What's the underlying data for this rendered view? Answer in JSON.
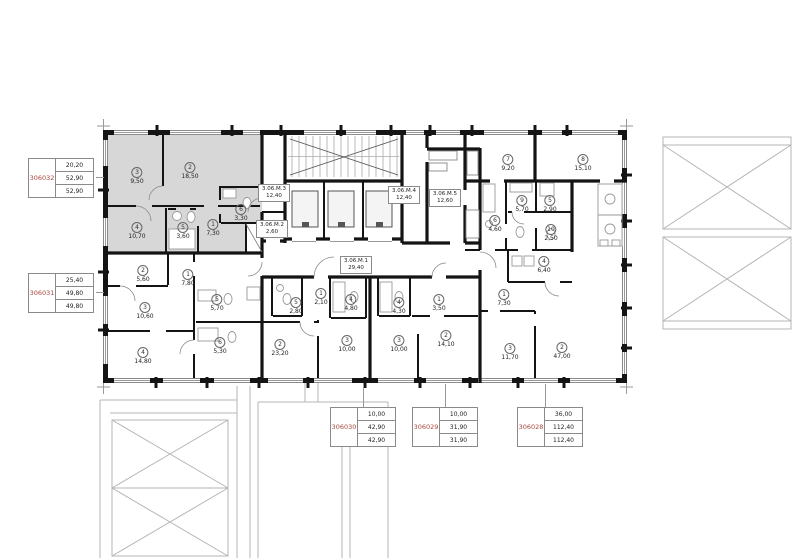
{
  "colors": {
    "accent-red": "#a8493e",
    "highlight": "#d7d7d7",
    "wall": "#141414",
    "line": "#999999",
    "neighbor": "#b5b5b5"
  },
  "units": [
    {
      "id": "306032",
      "highlighted": true,
      "tag_values": [
        "20,20",
        "52,90",
        "52,90"
      ],
      "rooms": [
        {
          "n": "3",
          "area": "9,50"
        },
        {
          "n": "2",
          "area": "18,50"
        },
        {
          "n": "4",
          "area": "10,70"
        },
        {
          "n": "5",
          "area": "3,60"
        },
        {
          "n": "1",
          "area": "7,30"
        },
        {
          "n": "6",
          "area": "3,30"
        }
      ]
    },
    {
      "id": "306031",
      "highlighted": false,
      "tag_values": [
        "25,40",
        "49,80",
        "49,80"
      ],
      "rooms": [
        {
          "n": "2",
          "area": "5,60"
        },
        {
          "n": "1",
          "area": "7,80"
        },
        {
          "n": "3",
          "area": "10,60"
        },
        {
          "n": "5",
          "area": "5,70"
        },
        {
          "n": "6",
          "area": "5,30"
        },
        {
          "n": "4",
          "area": "14,80"
        }
      ]
    },
    {
      "id": "306030",
      "highlighted": false,
      "tag_values": [
        "10,00",
        "42,90",
        "42,90"
      ],
      "rooms": [
        {
          "n": "5",
          "area": "2,80"
        },
        {
          "n": "1",
          "area": "2,10"
        },
        {
          "n": "4",
          "area": "4,80"
        },
        {
          "n": "3",
          "area": "10,00"
        },
        {
          "n": "2",
          "area": "23,20"
        }
      ]
    },
    {
      "id": "306029",
      "highlighted": false,
      "tag_values": [
        "10,00",
        "31,90",
        "31,90"
      ],
      "rooms": [
        {
          "n": "4",
          "area": "4,30"
        },
        {
          "n": "3",
          "area": "10,00"
        },
        {
          "n": "1",
          "area": "3,50"
        },
        {
          "n": "2",
          "area": "14,10"
        }
      ]
    },
    {
      "id": "306028",
      "highlighted": false,
      "tag_values": [
        "36,00",
        "112,40",
        "112,40"
      ],
      "rooms": [
        {
          "n": "7",
          "area": "9,20"
        },
        {
          "n": "8",
          "area": "15,10"
        },
        {
          "n": "9",
          "area": "5,70"
        },
        {
          "n": "5",
          "area": "2,90"
        },
        {
          "n": "6",
          "area": "4,60"
        },
        {
          "n": "10",
          "area": "2,50"
        },
        {
          "n": "4",
          "area": "6,40"
        },
        {
          "n": "1",
          "area": "7,30"
        },
        {
          "n": "3",
          "area": "11,70"
        },
        {
          "n": "2",
          "area": "47,00"
        }
      ]
    }
  ],
  "common_areas": [
    {
      "name": "3.06.М.3",
      "area": "12,40"
    },
    {
      "name": "3.06.М.2",
      "area": "2,60"
    },
    {
      "name": "3.06.М.4",
      "area": "12,40"
    },
    {
      "name": "3.06.М.5",
      "area": "12,60"
    },
    {
      "name": "3.06.М.1",
      "area": "29,40"
    }
  ]
}
